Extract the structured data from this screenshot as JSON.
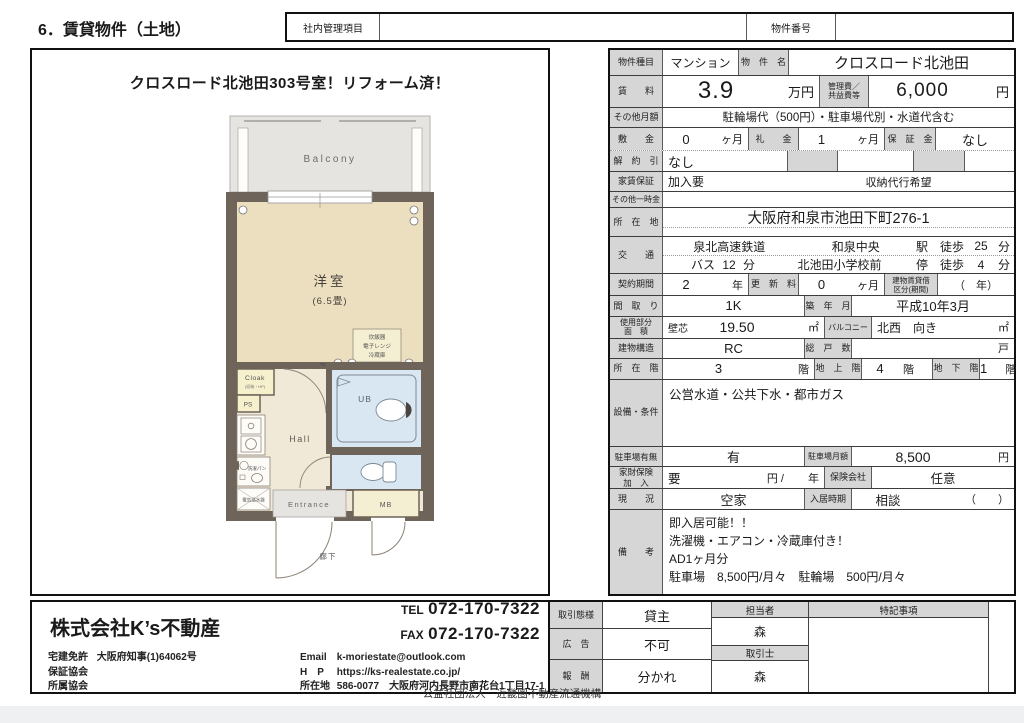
{
  "page": {
    "title": "6．賃貸物件（土地）",
    "internal_label": "社内管理項目",
    "property_no_label": "物件番号",
    "footer": "公益社団法人　近畿圏不動産流通機構"
  },
  "plan": {
    "headline": "クロスロード北池田303号室！リフォーム済！",
    "balcony": "Balcony",
    "room_name": "洋室",
    "room_size": "(6.5畳)",
    "appliance1": "炊飯器",
    "appliance2": "電子レンジ",
    "appliance3": "冷蔵庫",
    "tel": "TEL",
    "cloak": "Cloak",
    "cloak_sub": "(収納・HP)",
    "ps": "PS",
    "hall": "Hall",
    "laundry": "洗濯パン",
    "water_heater": "電気温水器",
    "ub": "UB",
    "entrance": "Entrance",
    "mb": "MB",
    "corridor": "廊下"
  },
  "t": {
    "type_label": "物件種目",
    "type": "マンション",
    "name_label": "物　件　名",
    "name": "クロスロード北池田",
    "rent_label": "賃　　料",
    "rent": "3.9",
    "rent_unit": "万円",
    "mgmt_label1": "管理費／",
    "mgmt_label2": "共益費等",
    "mgmt": "6,000",
    "mgmt_unit": "円",
    "other_monthly_label": "その他月額",
    "other_monthly": "駐輪場代（500円）・駐車場代別・水道代含む",
    "deposit_label": "敷　　金",
    "deposit": "0",
    "deposit_unit": "ヶ月",
    "key_label": "礼　　金",
    "key": "1",
    "key_unit": "ヶ月",
    "guarantee_label": "保　証　金",
    "guarantee": "なし",
    "cancel_label": "解　約　引",
    "cancel": "なし",
    "rent_guarantee_label": "家賃保証",
    "rent_guarantee": "加入要",
    "rent_guarantee_note": "収納代行希望",
    "onetime_label": "その他一時金",
    "address_label": "所　在　地",
    "address": "大阪府和泉市池田下町276-1",
    "traffic_label": "交　　通",
    "rail": "泉北高速鉄道",
    "station": "和泉中央",
    "walk1_label": "駅　徒歩",
    "walk1": "25",
    "walk1_unit": "分",
    "bus": "バス",
    "bus_min": "12",
    "bus_min_unit": "分",
    "stop": "北池田小学校前",
    "walk2_label": "停　徒歩",
    "walk2": "4",
    "walk2_unit": "分",
    "contract_label": "契約期間",
    "contract": "2",
    "contract_unit": "年",
    "renewal_label": "更　新　料",
    "renewal": "0",
    "renewal_unit": "ヶ月",
    "lease_type_label1": "建物賃貸借",
    "lease_type_label2": "区分(期間)",
    "lease_type": "（　年）",
    "layout_label": "間　取　り",
    "layout": "1K",
    "built_label": "築　年　月",
    "built": "平成10年3月",
    "area_label1": "使用部分",
    "area_label2": "面　積",
    "area_method": "壁芯",
    "area": "19.50",
    "area_unit": "㎡",
    "balcony_label": "バルコニー",
    "balcony_dir": "北西　向き",
    "balcony_unit": "㎡",
    "structure_label": "建物構造",
    "structure": "RC",
    "units_label": "総　戸　数",
    "units_unit": "戸",
    "floor_label": "所　在　階",
    "floor": "3",
    "floor_unit": "階",
    "above_label": "地　上　階",
    "above": "4",
    "above_unit": "階",
    "below_label": "地　下　階",
    "below": "1",
    "below_unit": "階",
    "facility_label": "設備・条件",
    "facility": "公営水道・公共下水・都市ガス",
    "parking_label": "駐車場有無",
    "parking": "有",
    "parking_fee_label": "駐車場月額",
    "parking_fee": "8,500",
    "parking_fee_unit": "円",
    "insurance_label1": "家財保険",
    "insurance_label2": "加　入",
    "insurance": "要",
    "insurance_unit": "円 /",
    "insurance_unit2": "年",
    "insurer_label": "保険会社",
    "insurer": "任意",
    "status_label": "現　　況",
    "status": "空家",
    "movein_label": "入居時期",
    "movein": "相談",
    "movein_paren": "（　　）",
    "notes_label": "備　　考",
    "notes1": "即入居可能！！",
    "notes2": "洗濯機・エアコン・冷蔵庫付き！",
    "notes3": "AD1ヶ月分",
    "notes4": "駐車場　8,500円/月々　駐輪場　500円/月々"
  },
  "agency": {
    "name": "株式会社K’s不動産",
    "tel_label": "TEL",
    "tel": "072-170-7322",
    "fax_label": "FAX",
    "fax": "072-170-7322",
    "license_label": "宅建免許",
    "license": "大阪府知事(1)64062号",
    "guarantee_assoc_label": "保証協会",
    "member_assoc_label": "所属協会",
    "email_label": "Email",
    "email": "k-moriestate@outlook.com",
    "hp_label": "H　P",
    "hp": "https://ks-realestate.co.jp/",
    "addr_label": "所在地",
    "addr": "586-0077　大阪府河内長野市南花台1丁目17-1"
  },
  "deal": {
    "mode_label": "取引態様",
    "mode": "貸主",
    "ad_label": "広　告",
    "ad": "不可",
    "fee_label": "報　酬",
    "fee": "分かれ",
    "staff_label": "担当者",
    "staff": "森",
    "agent_label": "取引士",
    "agent": "森",
    "special_label": "特記事項"
  }
}
